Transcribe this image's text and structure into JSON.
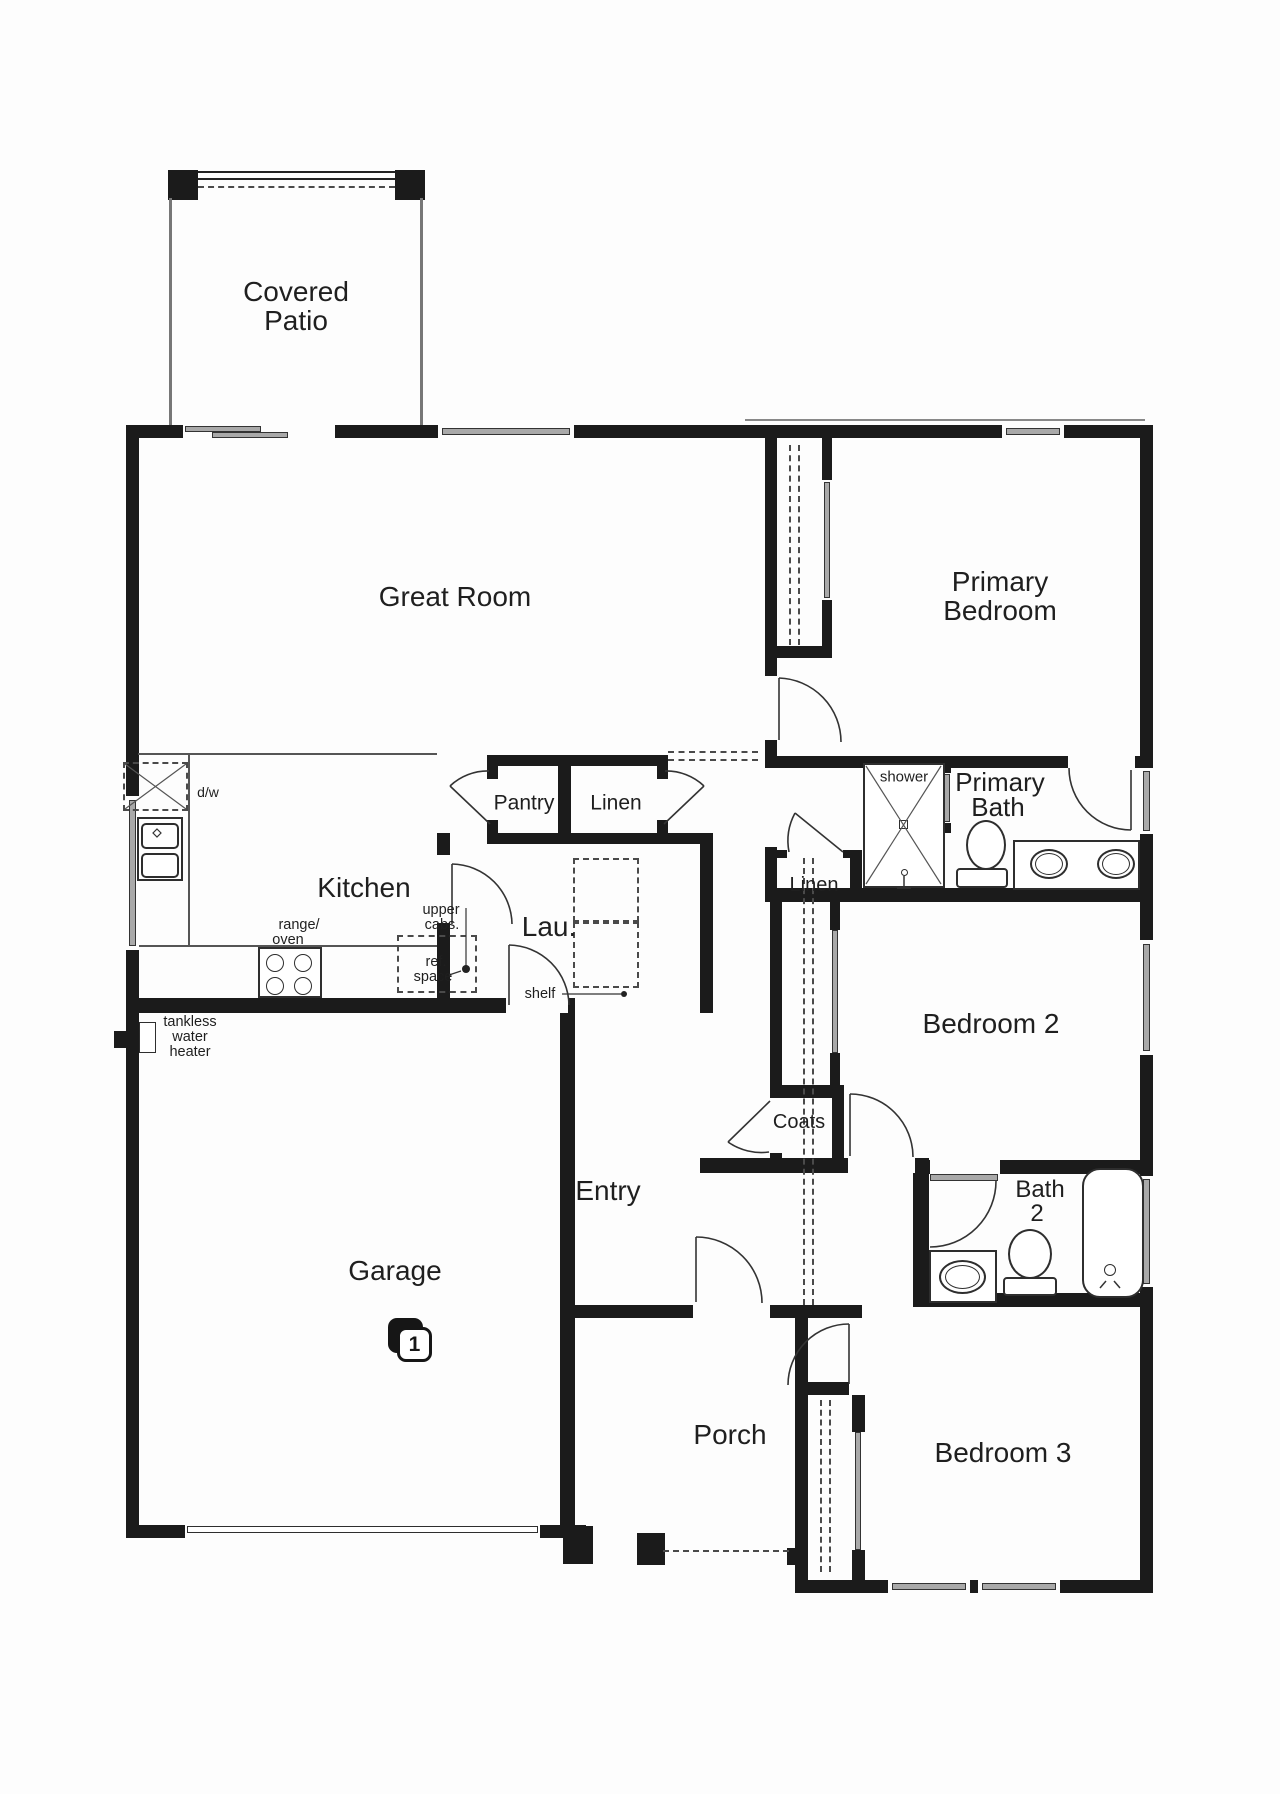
{
  "meta": {
    "type": "floor-plan",
    "description": "Single-story 3-bedroom house floor plan with garage, covered patio and porch"
  },
  "badge": {
    "name": "garage-bay-count-badge",
    "text": "1",
    "x": 388,
    "y": 1318
  },
  "labels": [
    {
      "name": "covered-patio-line1",
      "text": "Covered",
      "x": 296,
      "y": 292,
      "size": 28
    },
    {
      "name": "covered-patio-line2",
      "text": "Patio",
      "x": 296,
      "y": 321,
      "size": 28
    },
    {
      "name": "great-room",
      "text": "Great Room",
      "x": 455,
      "y": 597,
      "size": 28
    },
    {
      "name": "primary-bedroom-line1",
      "text": "Primary",
      "x": 1000,
      "y": 582,
      "size": 28
    },
    {
      "name": "primary-bedroom-line2",
      "text": "Bedroom",
      "x": 1000,
      "y": 611,
      "size": 28
    },
    {
      "name": "kitchen",
      "text": "Kitchen",
      "x": 364,
      "y": 888,
      "size": 28
    },
    {
      "name": "laundry",
      "text": "Lau.",
      "x": 549,
      "y": 927,
      "size": 28
    },
    {
      "name": "pantry",
      "text": "Pantry",
      "x": 524,
      "y": 803,
      "size": 21
    },
    {
      "name": "linen-hall",
      "text": "Linen",
      "x": 616,
      "y": 803,
      "size": 21
    },
    {
      "name": "primary-bath-line1",
      "text": "Primary",
      "x": 1000,
      "y": 782,
      "size": 26
    },
    {
      "name": "primary-bath-line2",
      "text": "Bath",
      "x": 998,
      "y": 807,
      "size": 26
    },
    {
      "name": "shower",
      "text": "shower",
      "x": 904,
      "y": 777,
      "size": 15
    },
    {
      "name": "linen-bath",
      "text": "Linen",
      "x": 814,
      "y": 885,
      "size": 20
    },
    {
      "name": "bedroom-2",
      "text": "Bedroom 2",
      "x": 991,
      "y": 1024,
      "size": 28
    },
    {
      "name": "coats",
      "text": "Coats",
      "x": 799,
      "y": 1122,
      "size": 20
    },
    {
      "name": "entry",
      "text": "Entry",
      "x": 608,
      "y": 1191,
      "size": 28
    },
    {
      "name": "bath-2-line1",
      "text": "Bath",
      "x": 1040,
      "y": 1190,
      "size": 24
    },
    {
      "name": "bath-2-line2",
      "text": "2",
      "x": 1037,
      "y": 1214,
      "size": 24
    },
    {
      "name": "garage",
      "text": "Garage",
      "x": 395,
      "y": 1271,
      "size": 28
    },
    {
      "name": "porch",
      "text": "Porch",
      "x": 730,
      "y": 1435,
      "size": 28
    },
    {
      "name": "bedroom-3",
      "text": "Bedroom 3",
      "x": 1003,
      "y": 1453,
      "size": 28
    },
    {
      "name": "dishwasher",
      "text": "d/w",
      "x": 208,
      "y": 792,
      "size": 14
    },
    {
      "name": "range-line1",
      "text": "range/",
      "x": 299,
      "y": 925,
      "size": 14.5
    },
    {
      "name": "range-line2",
      "text": "oven",
      "x": 288,
      "y": 940,
      "size": 14.5
    },
    {
      "name": "upper-cabs-line1",
      "text": "upper",
      "x": 441,
      "y": 910,
      "size": 14.5
    },
    {
      "name": "upper-cabs-line2",
      "text": "cabs.",
      "x": 442,
      "y": 925,
      "size": 14.5
    },
    {
      "name": "ref-space-line1",
      "text": "ref.",
      "x": 436,
      "y": 962,
      "size": 14.5
    },
    {
      "name": "ref-space-line2",
      "text": "space",
      "x": 433,
      "y": 977,
      "size": 14.5
    },
    {
      "name": "shelf",
      "text": "shelf",
      "x": 540,
      "y": 994,
      "size": 14.5
    },
    {
      "name": "tankless-line1",
      "text": "tankless",
      "x": 190,
      "y": 1022,
      "size": 14.5
    },
    {
      "name": "tankless-line2",
      "text": "water",
      "x": 190,
      "y": 1037,
      "size": 14.5
    },
    {
      "name": "tankless-line3",
      "text": "heater",
      "x": 190,
      "y": 1052,
      "size": 14.5
    }
  ],
  "plan": {
    "walls": [
      [
        126,
        425,
        1027,
        13
      ],
      [
        126,
        425,
        13,
        1113
      ],
      [
        1140,
        425,
        13,
        1168
      ],
      [
        126,
        1525,
        460,
        13
      ],
      [
        795,
        1580,
        358,
        13
      ],
      [
        765,
        438,
        12,
        330
      ],
      [
        765,
        847,
        12,
        41
      ],
      [
        822,
        438,
        10,
        220
      ],
      [
        765,
        646,
        67,
        12
      ],
      [
        765,
        756,
        386,
        12
      ],
      [
        765,
        888,
        388,
        14
      ],
      [
        765,
        850,
        97,
        8
      ],
      [
        850,
        850,
        12,
        38
      ],
      [
        487,
        755,
        181,
        11
      ],
      [
        487,
        833,
        226,
        11
      ],
      [
        487,
        755,
        11,
        89
      ],
      [
        558,
        764,
        13,
        69
      ],
      [
        657,
        755,
        11,
        89
      ],
      [
        437,
        833,
        13,
        180
      ],
      [
        700,
        844,
        13,
        169
      ],
      [
        126,
        998,
        449,
        15
      ],
      [
        560,
        1013,
        15,
        512
      ],
      [
        770,
        888,
        12,
        285
      ],
      [
        770,
        1085,
        74,
        13
      ],
      [
        830,
        893,
        10,
        193
      ],
      [
        832,
        1085,
        12,
        88
      ],
      [
        700,
        1158,
        229,
        15
      ],
      [
        913,
        1160,
        240,
        14
      ],
      [
        913,
        1174,
        16,
        120
      ],
      [
        913,
        1293,
        227,
        14
      ],
      [
        575,
        1305,
        287,
        13
      ],
      [
        795,
        1318,
        13,
        262
      ],
      [
        808,
        1382,
        41,
        13
      ],
      [
        852,
        1395,
        13,
        185
      ],
      [
        563,
        1526,
        30,
        38
      ],
      [
        637,
        1533,
        28,
        32
      ],
      [
        787,
        1548,
        17,
        17
      ],
      [
        168,
        170,
        30,
        30
      ],
      [
        395,
        170,
        30,
        30
      ],
      [
        114,
        1031,
        14,
        17
      ],
      [
        943,
        763,
        8,
        10
      ],
      [
        943,
        823,
        8,
        10
      ]
    ],
    "cuts": [
      [
        183,
        425,
        152,
        13
      ],
      [
        438,
        425,
        136,
        13
      ],
      [
        1002,
        425,
        62,
        13
      ],
      [
        126,
        796,
        13,
        154
      ],
      [
        1140,
        768,
        13,
        66
      ],
      [
        1140,
        940,
        13,
        115
      ],
      [
        1140,
        1176,
        13,
        111
      ],
      [
        185,
        1525,
        355,
        13
      ],
      [
        888,
        1580,
        82,
        13
      ],
      [
        978,
        1580,
        82,
        13
      ],
      [
        765,
        676,
        12,
        64
      ],
      [
        1068,
        756,
        67,
        12
      ],
      [
        787,
        850,
        56,
        8
      ],
      [
        487,
        779,
        11,
        41
      ],
      [
        657,
        779,
        11,
        41
      ],
      [
        437,
        855,
        13,
        68
      ],
      [
        506,
        998,
        62,
        15
      ],
      [
        822,
        480,
        10,
        120
      ],
      [
        770,
        1098,
        12,
        55
      ],
      [
        830,
        930,
        10,
        123
      ],
      [
        848,
        1158,
        67,
        15
      ],
      [
        930,
        1160,
        70,
        14
      ],
      [
        693,
        1305,
        77,
        13
      ],
      [
        852,
        1432,
        13,
        118
      ]
    ],
    "gray_panels": [
      [
        185,
        426,
        76,
        6
      ],
      [
        212,
        432,
        76,
        6
      ],
      [
        442,
        428,
        128,
        7
      ],
      [
        1006,
        428,
        54,
        7
      ],
      [
        129,
        800,
        7,
        146
      ],
      [
        1143,
        771,
        7,
        60
      ],
      [
        1143,
        944,
        7,
        107
      ],
      [
        1143,
        1179,
        7,
        105
      ],
      [
        892,
        1583,
        74,
        7
      ],
      [
        982,
        1583,
        74,
        7
      ],
      [
        824,
        482,
        6,
        116
      ],
      [
        832,
        930,
        6,
        123
      ],
      [
        855,
        1432,
        6,
        118
      ],
      [
        944,
        774,
        6,
        48
      ],
      [
        930,
        1174,
        68,
        7
      ]
    ],
    "thin_lines": [
      {
        "r": [
          138,
          753,
          299,
          2
        ],
        "c": "#555"
      },
      {
        "r": [
          188,
          755,
          2,
          192
        ],
        "c": "#555"
      },
      {
        "r": [
          139,
          945,
          298,
          2
        ],
        "c": "#555"
      },
      {
        "r": [
          745,
          419,
          400,
          2
        ],
        "c": "#888"
      },
      {
        "r": [
          169,
          198,
          3,
          227
        ],
        "c": "#777"
      },
      {
        "r": [
          420,
          198,
          3,
          227
        ],
        "c": "#777"
      },
      {
        "r": [
          198,
          171,
          197,
          2
        ],
        "c": "#222"
      },
      {
        "r": [
          198,
          178,
          197,
          2
        ],
        "c": "#222"
      }
    ],
    "dashed_h": [
      [
        668,
        751,
        90
      ],
      [
        668,
        759,
        90
      ],
      [
        663,
        1550,
        126
      ],
      [
        198,
        186,
        197
      ]
    ],
    "dashed_v": [
      [
        789,
        445,
        200
      ],
      [
        798,
        445,
        200
      ],
      [
        803,
        858,
        447
      ],
      [
        812,
        858,
        447
      ],
      [
        820,
        1400,
        172
      ],
      [
        829,
        1400,
        172
      ]
    ],
    "dashed_rects": [
      [
        123,
        762,
        65,
        49
      ],
      [
        573,
        858,
        66,
        64
      ],
      [
        573,
        922,
        66,
        66
      ],
      [
        397,
        935,
        80,
        58
      ]
    ],
    "outlines": [
      {
        "name": "shower-pan",
        "x": 863,
        "y": 763,
        "w": 82,
        "h": 125
      },
      {
        "name": "shower-drain",
        "x": 899,
        "y": 820,
        "w": 9,
        "h": 9,
        "bw": 1.5
      },
      {
        "name": "primary-toilet-base",
        "x": 956,
        "y": 868,
        "w": 52,
        "h": 20,
        "r": 4
      },
      {
        "name": "primary-vanity",
        "x": 1013,
        "y": 840,
        "w": 127,
        "h": 50
      },
      {
        "name": "kitchen-sink-counter",
        "x": 137,
        "y": 817,
        "w": 46,
        "h": 64
      },
      {
        "name": "kitchen-sink-basin-1",
        "x": 141,
        "y": 823,
        "w": 38,
        "h": 26,
        "r": 5
      },
      {
        "name": "kitchen-sink-basin-2",
        "x": 141,
        "y": 853,
        "w": 38,
        "h": 25,
        "r": 5
      },
      {
        "name": "range-oven",
        "x": 258,
        "y": 947,
        "w": 64,
        "h": 51
      },
      {
        "name": "tankless-water-heater-unit",
        "x": 139,
        "y": 1022,
        "w": 17,
        "h": 31,
        "bw": 1.5
      },
      {
        "name": "bath2-vanity",
        "x": 929,
        "y": 1250,
        "w": 68,
        "h": 53
      },
      {
        "name": "bath2-toilet-base",
        "x": 1003,
        "y": 1277,
        "w": 54,
        "h": 19,
        "r": 4
      },
      {
        "name": "bathtub",
        "x": 1082,
        "y": 1168,
        "w": 62,
        "h": 130,
        "r": 18
      },
      {
        "name": "garage-door-panel",
        "x": 187,
        "y": 1526,
        "w": 351,
        "h": 7,
        "bw": 1.5
      }
    ],
    "ellipses": [
      {
        "name": "primary-toilet-bowl",
        "x": 966,
        "y": 820,
        "w": 40,
        "h": 50
      },
      {
        "name": "primary-sink-1",
        "x": 1030,
        "y": 849,
        "w": 38,
        "h": 30
      },
      {
        "name": "primary-sink-1-inner",
        "x": 1035,
        "y": 853,
        "w": 28,
        "h": 22,
        "bw": 1
      },
      {
        "name": "primary-sink-2",
        "x": 1097,
        "y": 849,
        "w": 38,
        "h": 30
      },
      {
        "name": "primary-sink-2-inner",
        "x": 1102,
        "y": 853,
        "w": 28,
        "h": 22,
        "bw": 1
      },
      {
        "name": "bath2-sink",
        "x": 939,
        "y": 1260,
        "w": 47,
        "h": 34
      },
      {
        "name": "bath2-sink-inner",
        "x": 945,
        "y": 1265,
        "w": 35,
        "h": 24,
        "bw": 1
      },
      {
        "name": "bath2-toilet-bowl",
        "x": 1008,
        "y": 1229,
        "w": 44,
        "h": 50
      },
      {
        "name": "tub-drain",
        "x": 1104,
        "y": 1264,
        "w": 12,
        "h": 12,
        "bw": 1.5
      },
      {
        "name": "shower-head",
        "x": 901,
        "y": 869,
        "w": 7,
        "h": 7,
        "bw": 1.5
      }
    ],
    "range_burners": [
      [
        275,
        963
      ],
      [
        303,
        963
      ],
      [
        275,
        986
      ],
      [
        303,
        986
      ]
    ],
    "paths": [
      {
        "name": "door-primary-bedroom-leaf",
        "d": "M779,678 L779,740"
      },
      {
        "name": "door-primary-bedroom-arc",
        "d": "M779,678 A64,64 0 0 1 841,742"
      },
      {
        "name": "door-primary-bath-leaf",
        "d": "M1131,770 L1131,830"
      },
      {
        "name": "door-primary-bath-arc",
        "d": "M1131,830 A62,62 0 0 1 1069,768"
      },
      {
        "name": "door-pantry-leaf",
        "d": "M490,824 L450,786"
      },
      {
        "name": "door-pantry-arc",
        "d": "M450,786 A55,55 0 0 1 489,771"
      },
      {
        "name": "door-linen-hall-leaf",
        "d": "M664,824 L704,786"
      },
      {
        "name": "door-linen-hall-arc",
        "d": "M704,786 A55,55 0 0 0 665,771"
      },
      {
        "name": "door-laundry-kitchen-leaf",
        "d": "M452,864 L452,924"
      },
      {
        "name": "door-laundry-kitchen-arc",
        "d": "M452,864 A61,61 0 0 1 512,924"
      },
      {
        "name": "door-laundry-garage-leaf",
        "d": "M509,945 L509,1005"
      },
      {
        "name": "door-laundry-garage-arc",
        "d": "M509,945 A61,61 0 0 1 569,1005"
      },
      {
        "name": "door-linen-bath-leaf",
        "d": "M843,852 L795,813"
      },
      {
        "name": "door-linen-bath-arc",
        "d": "M795,813 A59,59 0 0 0 789,852"
      },
      {
        "name": "door-coats-leaf",
        "d": "M770,1101 L728,1142"
      },
      {
        "name": "door-coats-arc",
        "d": "M728,1142 A58,58 0 0 0 769,1152"
      },
      {
        "name": "door-bedroom2-leaf",
        "d": "M850,1094 L850,1156"
      },
      {
        "name": "door-bedroom2-arc",
        "d": "M850,1094 A63,63 0 0 1 913,1157"
      },
      {
        "name": "door-bath2-arc",
        "d": "M996,1181 A66,66 0 0 1 930,1247"
      },
      {
        "name": "door-front-leaf",
        "d": "M696,1237 L696,1302"
      },
      {
        "name": "door-front-arc",
        "d": "M696,1237 A66,66 0 0 1 762,1303"
      },
      {
        "name": "door-bedroom3-leaf",
        "d": "M849,1324 L849,1384"
      },
      {
        "name": "door-bedroom3-arc",
        "d": "M849,1324 A61,61 0 0 0 788,1385"
      },
      {
        "name": "dishwasher-x-1",
        "d": "M125,764 L186,809",
        "sw": 1.2,
        "c": "#555"
      },
      {
        "name": "dishwasher-x-2",
        "d": "M186,764 L125,809",
        "sw": 1.2,
        "c": "#555"
      },
      {
        "name": "shower-x-1",
        "d": "M866,766 L941,884",
        "sw": 1.2,
        "c": "#555"
      },
      {
        "name": "shower-x-2",
        "d": "M941,766 L866,884",
        "sw": 1.2,
        "c": "#555"
      },
      {
        "name": "shower-valve-1",
        "d": "M904,876 L904,888",
        "sw": 1.5
      },
      {
        "name": "shower-valve-2",
        "d": "M897,888 L911,888",
        "sw": 1.5
      },
      {
        "name": "tub-faucet-1",
        "d": "M1100,1288 L1106,1281",
        "sw": 1.5
      },
      {
        "name": "tub-faucet-2",
        "d": "M1120,1288 L1114,1281",
        "sw": 1.5
      },
      {
        "name": "shelf-leader",
        "d": "M562,994 L621,994",
        "sw": 1.2
      },
      {
        "name": "upper-cabs-leader",
        "d": "M466,908 L466,966",
        "sw": 1.2
      },
      {
        "name": "ref-space-leader",
        "d": "M449,975 L461,971",
        "sw": 1.2
      },
      {
        "name": "sink-faucet-diamond",
        "d": "M157,829 L161,833 L157,837 L153,833 Z",
        "sw": 1.2
      }
    ],
    "dots": [
      [
        624,
        994,
        3
      ],
      [
        466,
        969,
        4
      ]
    ]
  }
}
